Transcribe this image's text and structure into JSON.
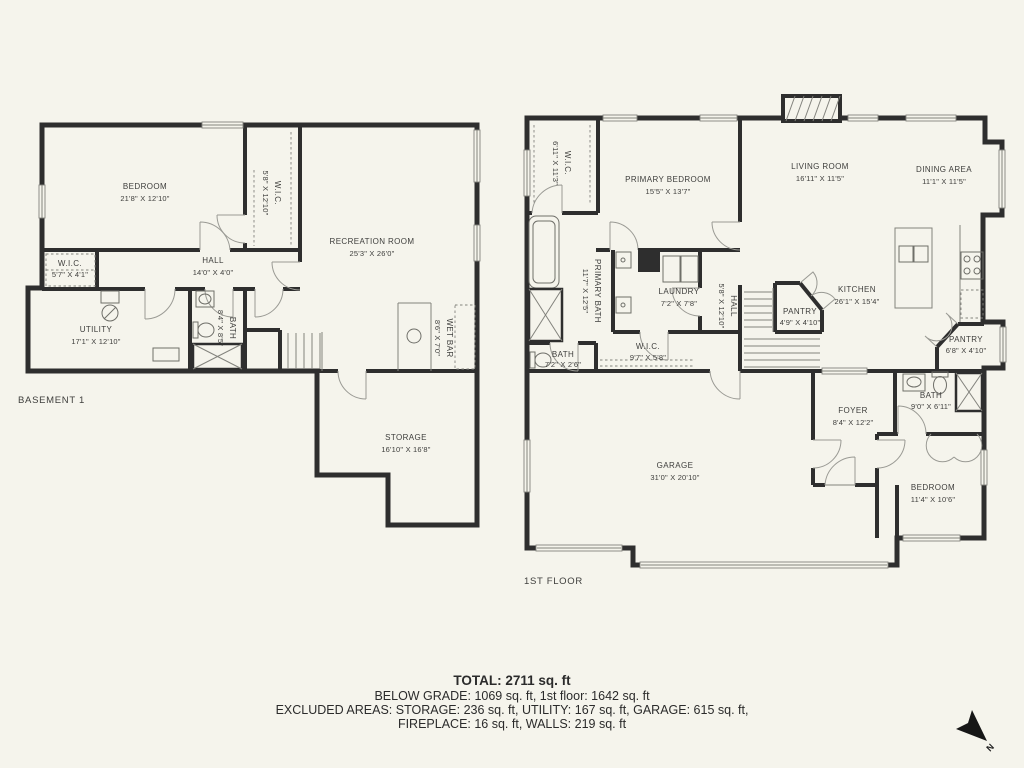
{
  "colors": {
    "background": "#f5f4ec",
    "wall": "#2e2e2e",
    "accent_line": "#83837d",
    "text": "#3e3e3c"
  },
  "basement": {
    "floor_label": "BASEMENT 1",
    "rooms": {
      "bedroom": {
        "name": "BEDROOM",
        "dims": "21'8\" X 12'10\""
      },
      "wic": {
        "name": "W.I.C.",
        "dims": "5'8\" X 12'10\""
      },
      "recreation": {
        "name": "RECREATION ROOM",
        "dims": "25'3\" X 26'0\""
      },
      "hall": {
        "name": "HALL",
        "dims": "14'0\" X 4'0\""
      },
      "wic2": {
        "name": "W.I.C.",
        "dims": "5'7\" X 4'1\""
      },
      "utility": {
        "name": "UTILITY",
        "dims": "17'1\" X 12'10\""
      },
      "bath": {
        "name": "BATH",
        "dims": "8'4\" X 8'5\""
      },
      "wet_bar": {
        "name": "WET BAR",
        "dims": "8'6\" X 7'0\""
      },
      "storage": {
        "name": "STORAGE",
        "dims": "16'10\" X 16'8\""
      }
    }
  },
  "first_floor": {
    "floor_label": "1ST FLOOR",
    "rooms": {
      "wic": {
        "name": "W.I.C.",
        "dims": "6'11\" X 11'3\""
      },
      "primary_bedroom": {
        "name": "PRIMARY BEDROOM",
        "dims": "15'5\" X 13'7\""
      },
      "living_room": {
        "name": "LIVING ROOM",
        "dims": "16'11\" X 11'5\""
      },
      "dining_area": {
        "name": "DINING AREA",
        "dims": "11'1\" X 11'5\""
      },
      "primary_bath": {
        "name": "PRIMARY BATH",
        "dims": "11'7\" X 12'5\""
      },
      "laundry": {
        "name": "LAUNDRY",
        "dims": "7'2\" X 7'8\""
      },
      "hall": {
        "name": "HALL",
        "dims": "5'8\" X 12'10\""
      },
      "kitchen": {
        "name": "KITCHEN",
        "dims": "26'1\" X 15'4\""
      },
      "pantry": {
        "name": "PANTRY",
        "dims": "4'9\" X 4'10\""
      },
      "pantry2": {
        "name": "PANTRY",
        "dims": "6'8\" X 4'10\""
      },
      "bath": {
        "name": "BATH",
        "dims": "7'2\" X 2'6\""
      },
      "wic2": {
        "name": "W.I.C.",
        "dims": "9'7\" X 5'8\""
      },
      "foyer": {
        "name": "FOYER",
        "dims": "8'4\" X 12'2\""
      },
      "bath2": {
        "name": "BATH",
        "dims": "9'0\" X 6'11\""
      },
      "garage": {
        "name": "GARAGE",
        "dims": "31'0\" X 20'10\""
      },
      "bedroom": {
        "name": "BEDROOM",
        "dims": "11'4\" X 10'6\""
      }
    }
  },
  "summary": {
    "total": "TOTAL: 2711 sq. ft",
    "below_grade": "BELOW GRADE: 1069 sq. ft, 1st floor: 1642 sq. ft",
    "excluded_1": "EXCLUDED AREAS: STORAGE: 236 sq. ft, UTILITY: 167 sq. ft, GARAGE: 615 sq. ft,",
    "excluded_2": "FIREPLACE: 16 sq. ft, WALLS: 219 sq. ft"
  },
  "compass": {
    "north_label": "N"
  }
}
